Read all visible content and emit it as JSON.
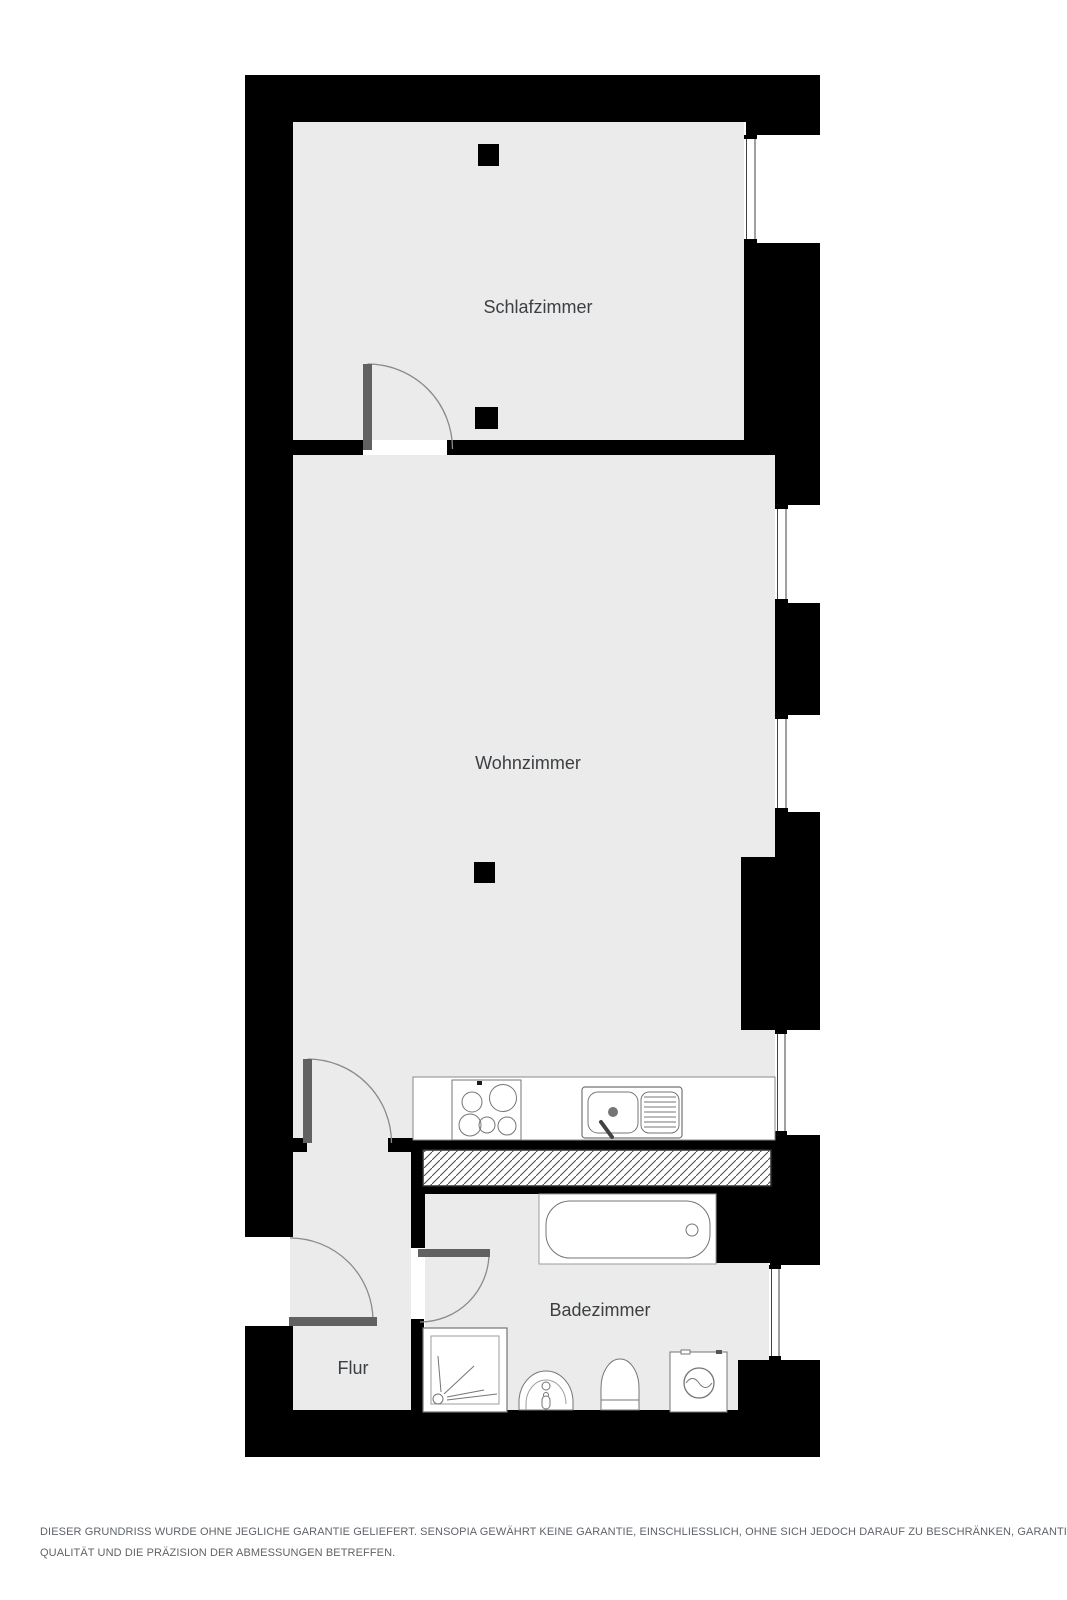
{
  "floorplan": {
    "rooms": [
      {
        "id": "schlafzimmer",
        "label": "Schlafzimmer"
      },
      {
        "id": "wohnzimmer",
        "label": "Wohnzimmer"
      },
      {
        "id": "badezimmer",
        "label": "Badezimmer"
      },
      {
        "id": "flur",
        "label": "Flur"
      }
    ],
    "fixtures": [
      "stove-cooktop",
      "kitchen-sink",
      "bathtub",
      "shower",
      "washbasin",
      "toilet",
      "washing-machine"
    ],
    "features": [
      "windows",
      "interior-doors",
      "entrance-door",
      "columns",
      "hatched-shaft"
    ],
    "colors": {
      "wall": "#000000",
      "floor": "#ebebeb",
      "fixture_fill": "#ffffff",
      "fixture_outline": "#757575",
      "door_leaf": "#616161",
      "door_arc": "#8a8a8a",
      "label_text": "#3c4043",
      "disclaimer_text": "#5f6368",
      "background": "#ffffff"
    }
  },
  "disclaimer": {
    "line1": "DIESER GRUNDRISS WURDE OHNE JEGLICHE GARANTIE GELIEFERT. SENSOPIA GEWÄHRT KEINE GARANTIE, EINSCHLIESSLICH, OHNE SICH JEDOCH DARAUF ZU BESCHRÄNKEN, GARANTIEN, DIE DIE",
    "line2": "QUALITÄT UND DIE PRÄZISION DER ABMESSUNGEN BETREFFEN."
  }
}
